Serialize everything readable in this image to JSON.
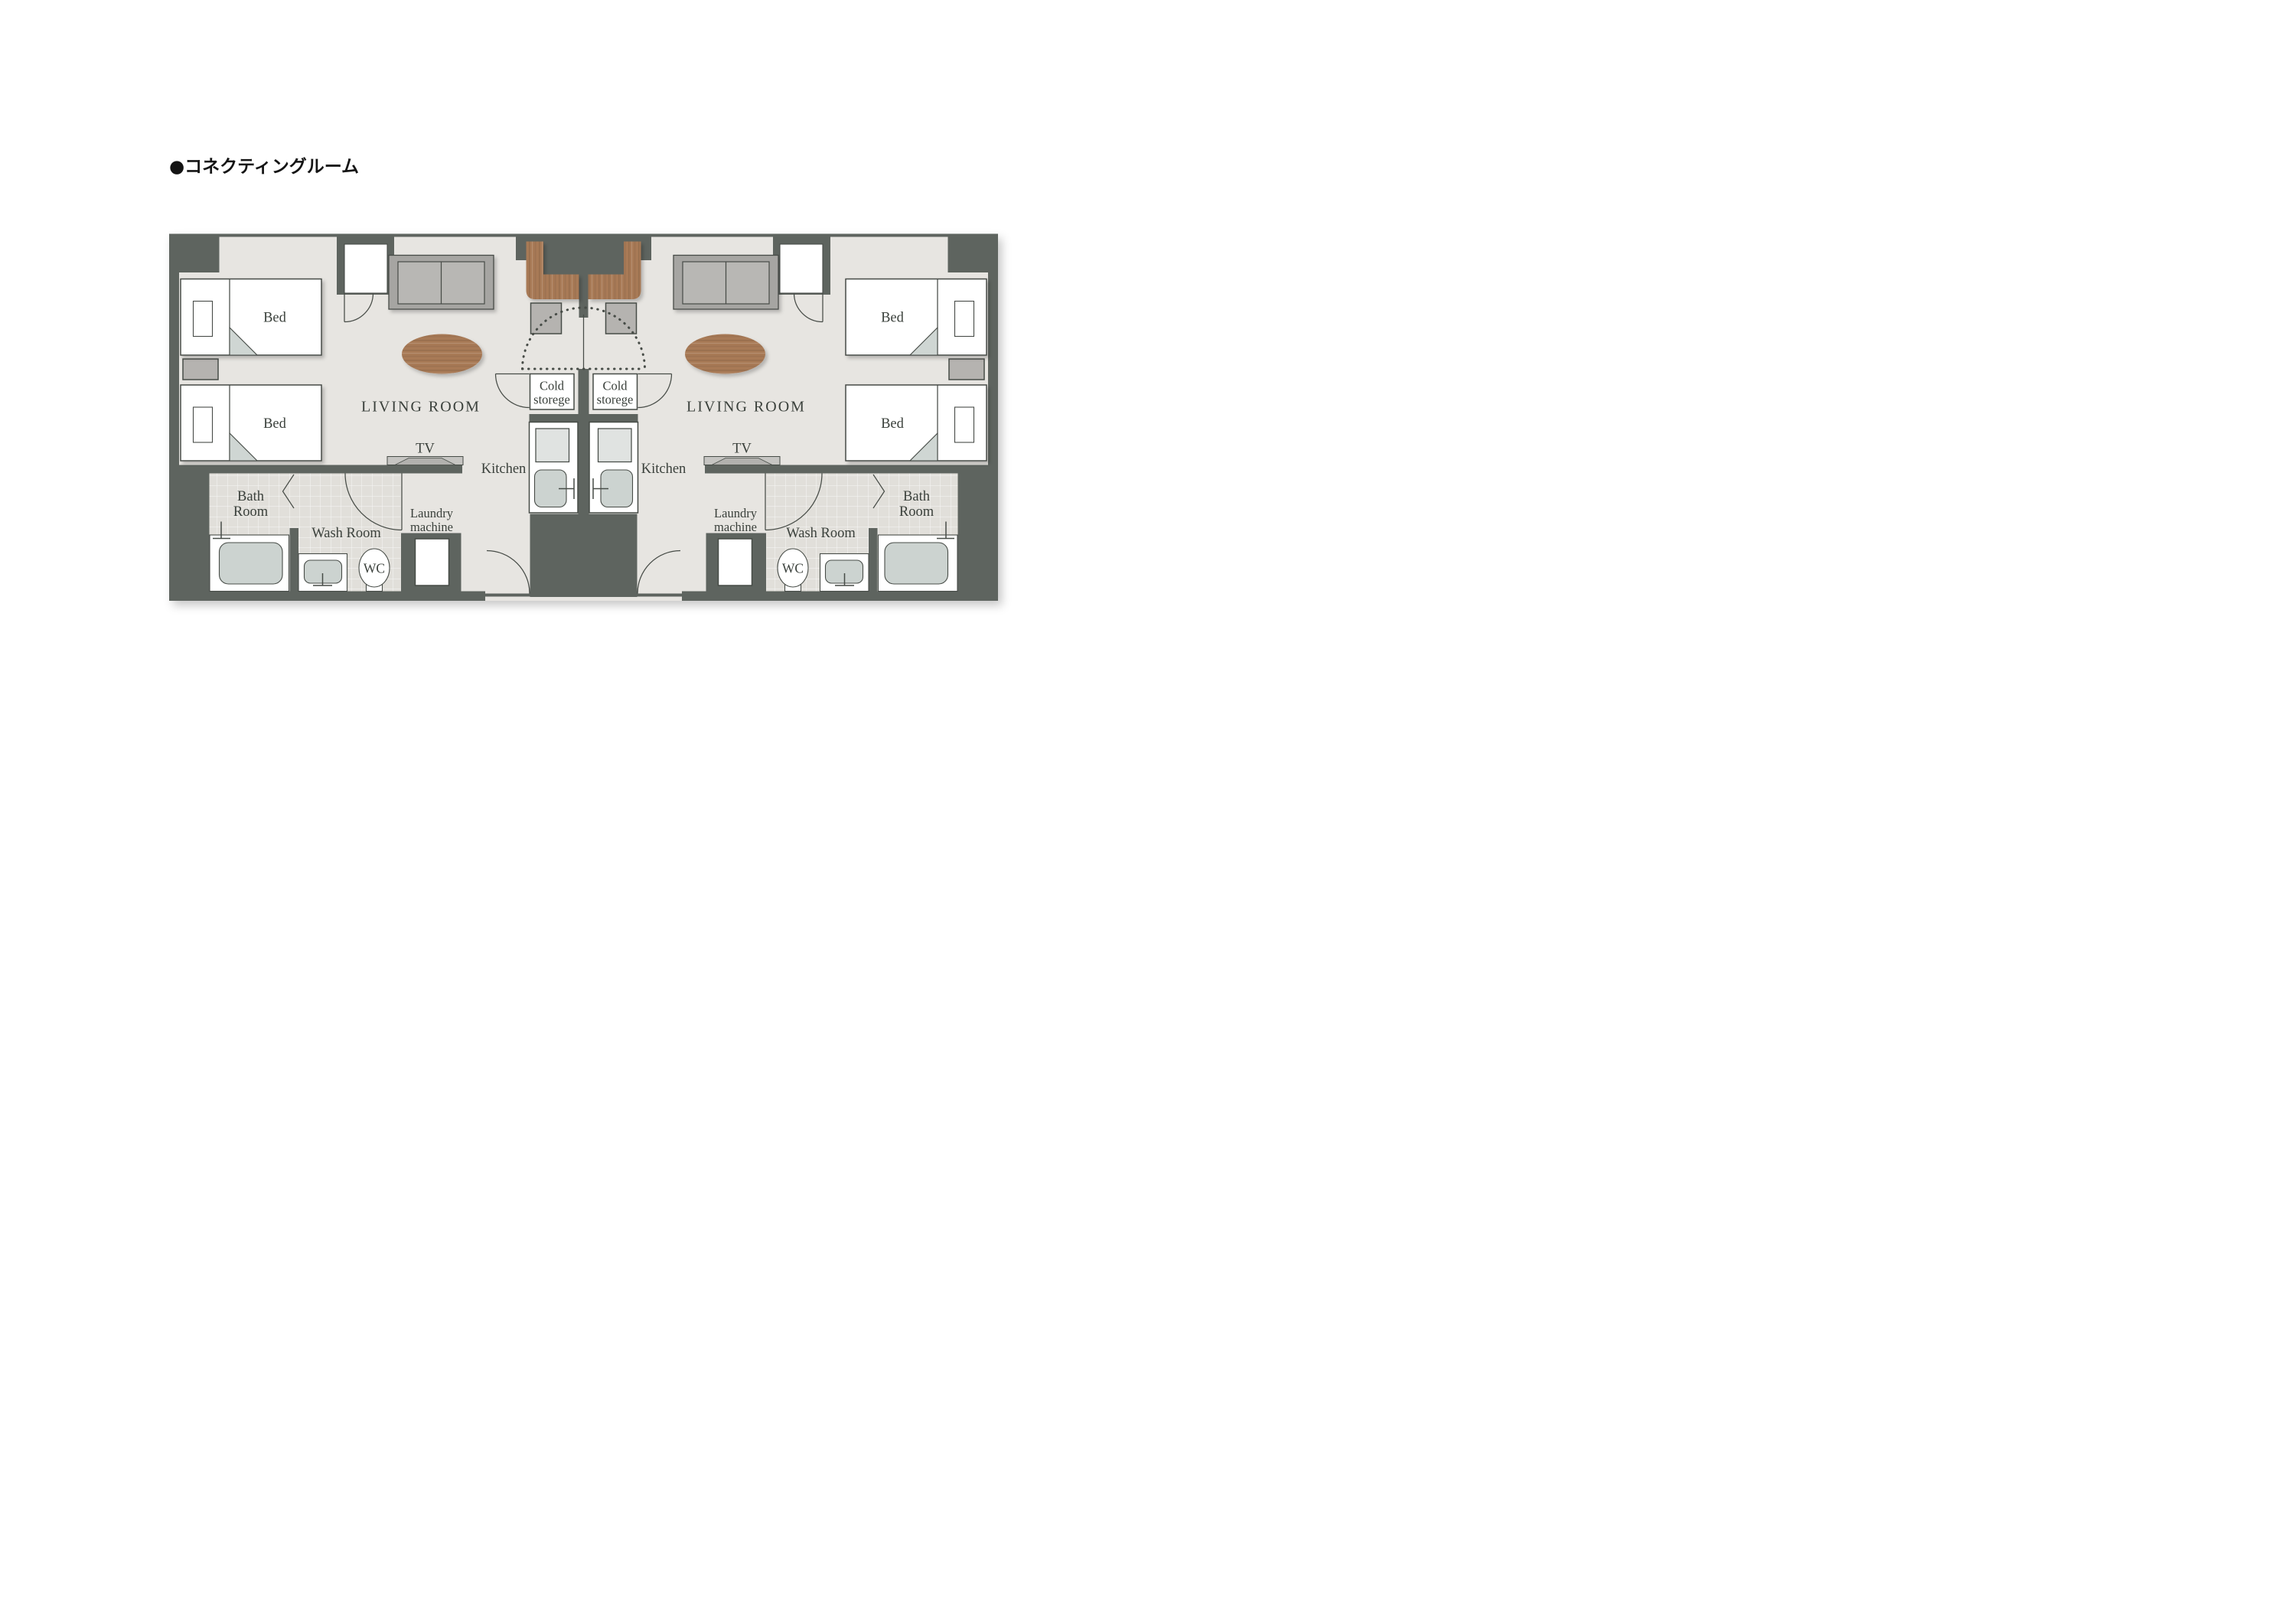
{
  "title": "●コネクティングルーム",
  "labels": {
    "bed": "Bed",
    "living_room": "LIVING ROOM",
    "tv": "TV",
    "kitchen": "Kitchen",
    "cold_storage_line1": "Cold",
    "cold_storage_line2": "storege",
    "laundry_line1": "Laundry",
    "laundry_line2": "machine",
    "wash_room": "Wash Room",
    "wc": "WC",
    "bath_room_line1": "Bath",
    "bath_room_line2": "Room"
  },
  "colors": {
    "wall": "#5e645f",
    "floor": "#e7e5e1",
    "tile": "#e1dfda",
    "line": "#474c47",
    "text": "#3a403b",
    "fixture": "#ccd3d0",
    "furniture": "#b5b3b0",
    "stove": "#e0e3e1",
    "wood": "#a87a56"
  }
}
